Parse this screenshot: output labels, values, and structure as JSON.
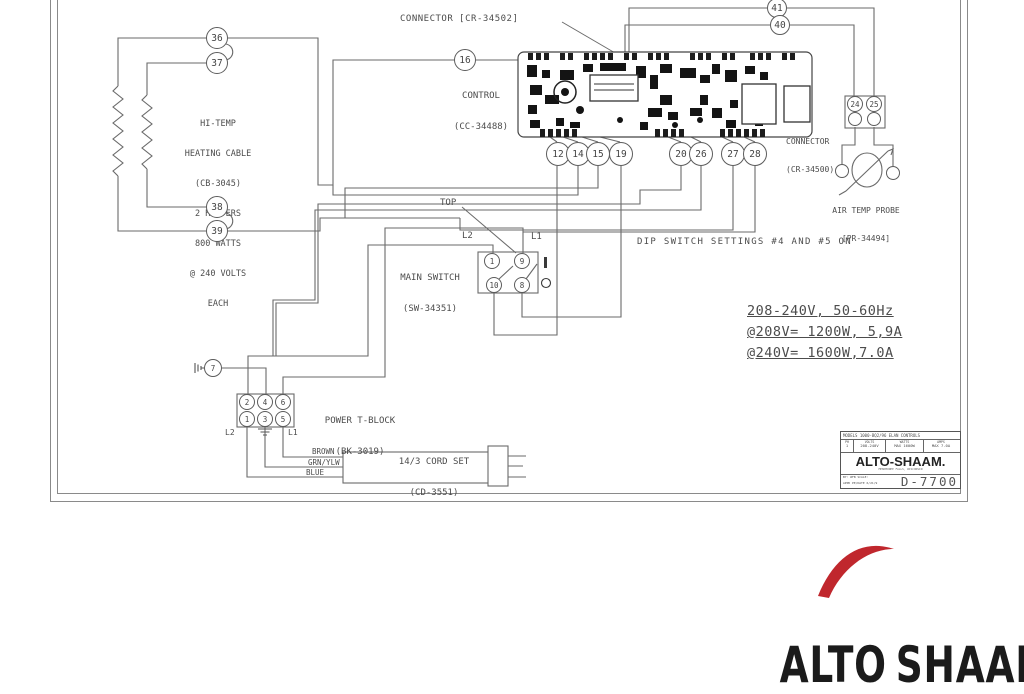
{
  "diagram": {
    "connector_top_label": "CONNECTOR [CR-34502]",
    "control_label1": "CONTROL",
    "control_label2": "(CC-34488)",
    "heater_lines": [
      "HI-TEMP",
      "HEATING CABLE",
      "(CB-3045)",
      "2 HEATERS",
      "800 WATTS",
      "@ 240 VOLTS",
      "EACH"
    ],
    "connector_right_label1": "CONNECTOR",
    "connector_right_label2": "(CR-34500)",
    "probe_label1": "AIR TEMP PROBE",
    "probe_label2": "[PR-34494]",
    "dip_note": "DIP SWITCH SETTINGS #4 AND #5 ON",
    "top_label": "TOP",
    "main_switch_label1": "MAIN SWITCH",
    "main_switch_label2": "(SW-34351)",
    "switch_l1": "L1",
    "switch_l2": "L2",
    "specs": [
      "208-240V, 50-60Hz",
      "@208V= 1200W, 5,9A",
      "@240V= 1600W,7.0A"
    ],
    "tblock_label1": "POWER T-BLOCK",
    "tblock_label2": "(BK-3019)",
    "tblock_l1": "L1",
    "tblock_l2": "L2",
    "cord_label1": "14/3 CORD SET",
    "cord_label2": "(CD-3551)",
    "cord_wires": [
      "BROWN",
      "GRN/YLW",
      "BLUE"
    ]
  },
  "terminals": [
    {
      "label": "36",
      "x": 217,
      "y": 38,
      "r": 11
    },
    {
      "label": "37",
      "x": 217,
      "y": 63,
      "r": 11
    },
    {
      "label": "38",
      "x": 217,
      "y": 207,
      "r": 11
    },
    {
      "label": "39",
      "x": 217,
      "y": 231,
      "r": 11
    },
    {
      "label": "16",
      "x": 465,
      "y": 60,
      "r": 11
    },
    {
      "label": "41",
      "x": 777,
      "y": 8,
      "r": 10
    },
    {
      "label": "40",
      "x": 780,
      "y": 25,
      "r": 10
    },
    {
      "label": "12",
      "x": 558,
      "y": 154,
      "r": 12
    },
    {
      "label": "14",
      "x": 578,
      "y": 154,
      "r": 12
    },
    {
      "label": "15",
      "x": 598,
      "y": 154,
      "r": 12
    },
    {
      "label": "19",
      "x": 621,
      "y": 154,
      "r": 12
    },
    {
      "label": "20",
      "x": 681,
      "y": 154,
      "r": 12
    },
    {
      "label": "26",
      "x": 701,
      "y": 154,
      "r": 12
    },
    {
      "label": "27",
      "x": 733,
      "y": 154,
      "r": 12
    },
    {
      "label": "28",
      "x": 755,
      "y": 154,
      "r": 12
    },
    {
      "label": "24",
      "x": 855,
      "y": 104,
      "r": 8
    },
    {
      "label": "25",
      "x": 874,
      "y": 104,
      "r": 8
    },
    {
      "label": "",
      "x": 855,
      "y": 119,
      "r": 7
    },
    {
      "label": "",
      "x": 874,
      "y": 119,
      "r": 7
    },
    {
      "label": "7",
      "x": 213,
      "y": 368,
      "r": 9
    },
    {
      "label": "1",
      "x": 492,
      "y": 261,
      "r": 8
    },
    {
      "label": "9",
      "x": 522,
      "y": 261,
      "r": 8
    },
    {
      "label": "10",
      "x": 494,
      "y": 285,
      "r": 8
    },
    {
      "label": "8",
      "x": 522,
      "y": 285,
      "r": 8
    },
    {
      "label": "2",
      "x": 247,
      "y": 402,
      "r": 8
    },
    {
      "label": "4",
      "x": 265,
      "y": 402,
      "r": 8
    },
    {
      "label": "6",
      "x": 283,
      "y": 402,
      "r": 8
    },
    {
      "label": "1",
      "x": 247,
      "y": 419,
      "r": 8
    },
    {
      "label": "3",
      "x": 265,
      "y": 419,
      "r": 8
    },
    {
      "label": "5",
      "x": 283,
      "y": 419,
      "r": 8
    },
    {
      "label": "",
      "x": 842,
      "y": 171,
      "r": 7
    },
    {
      "label": "",
      "x": 893,
      "y": 173,
      "r": 7
    }
  ],
  "title_block": {
    "models_line": "MODELS 1000-BQ2/96 ELAN CONTROLS",
    "col_headers": [
      "PH",
      "VOLTS",
      "WATTS",
      "AMPS"
    ],
    "col_values": [
      "1",
      "208-240V",
      "MAX 1600W",
      "MAX 7.0A"
    ],
    "brand": "ALTO-SHAAM.",
    "brand_sub": "MENOMONEE FALLS, WISCONSIN",
    "by_line": "BY: WFB   SCALE:",
    "appd_line": "APPD PE/DATE 6/21/9",
    "dwg_number": "D-7700"
  },
  "logo": {
    "left": "ALT",
    "o": "O",
    "right": "SHAAM"
  },
  "colors": {
    "line": "#6a6a6a",
    "text": "#4c4c4c",
    "logo_red": "#c0272d",
    "logo_black": "#1b1b1b"
  }
}
